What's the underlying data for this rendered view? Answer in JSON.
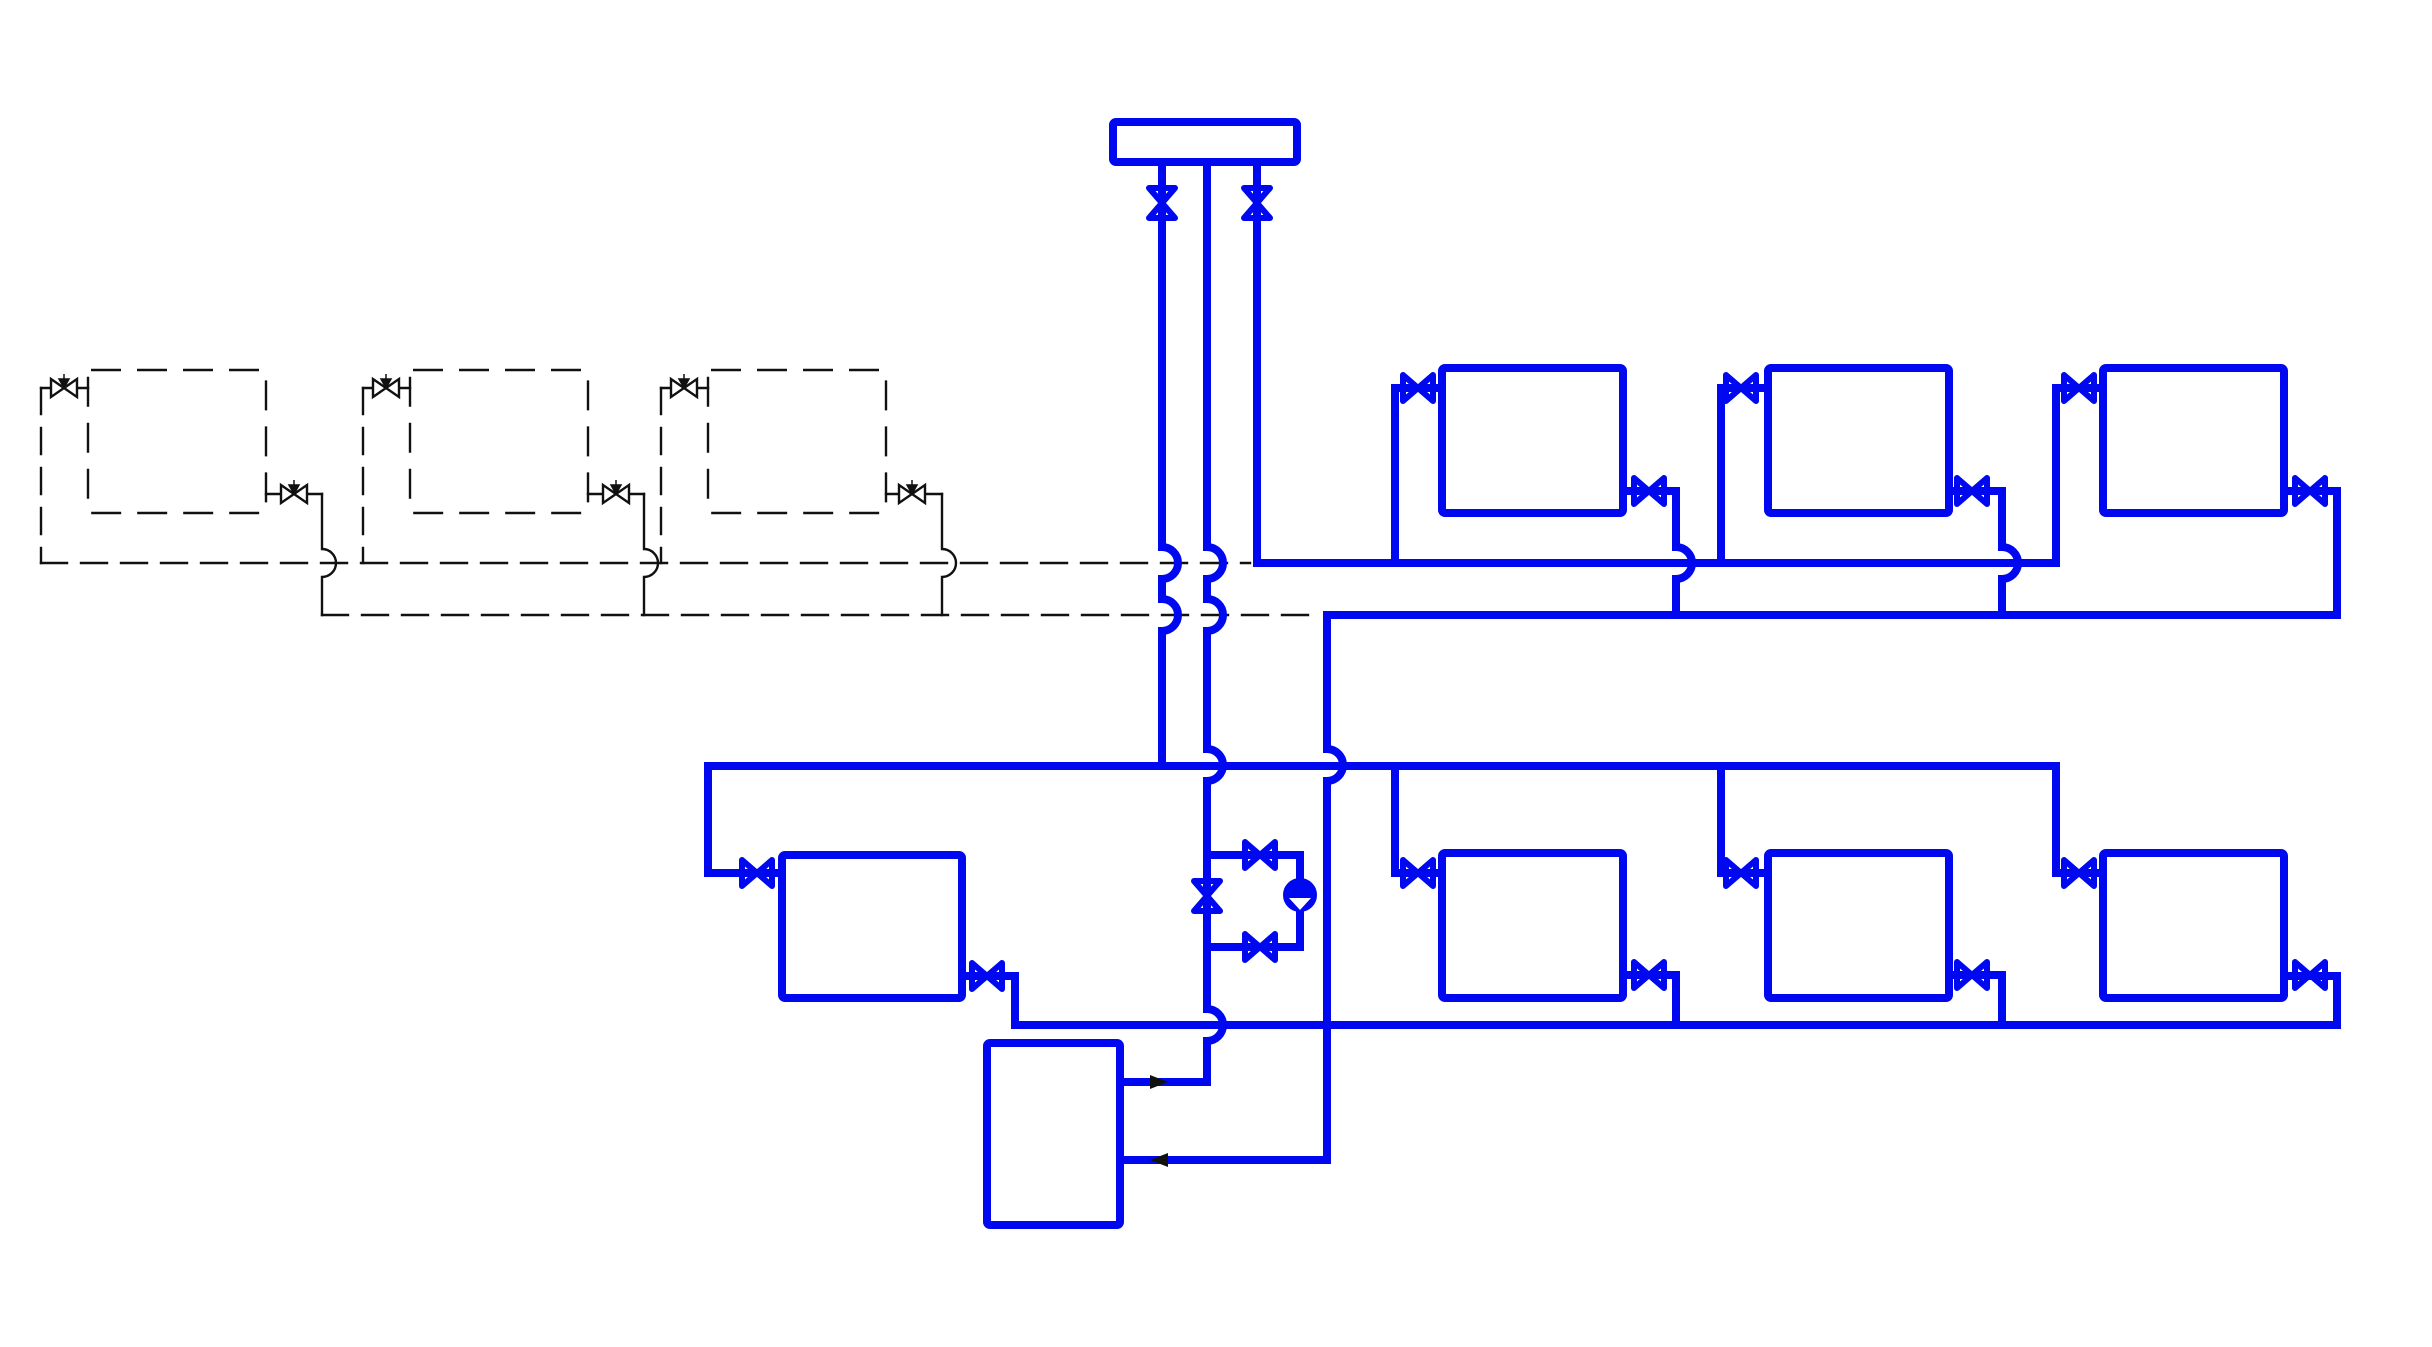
{
  "diagram": {
    "title": "heating-system-piping-schematic",
    "canvas": {
      "width": 2432,
      "height": 1347
    },
    "colors": {
      "pipe": "#0008f0",
      "planned": "#111111",
      "background": "#ffffff"
    },
    "stroke": {
      "pipe_width": 8,
      "planned_width": 2.4,
      "dash_line": "26 14",
      "dash_rect": "30 16"
    },
    "rects": [
      {
        "name": "supply-manifold",
        "x": 1113,
        "y": 122,
        "w": 184,
        "h": 40,
        "style": "pipe"
      },
      {
        "name": "boiler",
        "x": 987,
        "y": 1043,
        "w": 133,
        "h": 182,
        "style": "pipe"
      },
      {
        "name": "radiator-top-1",
        "x": 1442,
        "y": 368,
        "w": 181,
        "h": 145,
        "style": "pipe"
      },
      {
        "name": "radiator-top-2",
        "x": 1768,
        "y": 368,
        "w": 181,
        "h": 145,
        "style": "pipe"
      },
      {
        "name": "radiator-top-3",
        "x": 2103,
        "y": 368,
        "w": 181,
        "h": 145,
        "style": "pipe"
      },
      {
        "name": "radiator-bottom-left",
        "x": 782,
        "y": 855,
        "w": 180,
        "h": 143,
        "style": "pipe"
      },
      {
        "name": "radiator-bottom-1",
        "x": 1442,
        "y": 853,
        "w": 181,
        "h": 145,
        "style": "pipe"
      },
      {
        "name": "radiator-bottom-2",
        "x": 1768,
        "y": 853,
        "w": 181,
        "h": 145,
        "style": "pipe"
      },
      {
        "name": "radiator-bottom-3",
        "x": 2103,
        "y": 853,
        "w": 181,
        "h": 145,
        "style": "pipe"
      },
      {
        "name": "radiator-planned-1",
        "x": 88,
        "y": 370,
        "w": 178,
        "h": 143,
        "style": "planned",
        "dashed": true
      },
      {
        "name": "radiator-planned-2",
        "x": 410,
        "y": 370,
        "w": 178,
        "h": 143,
        "style": "planned",
        "dashed": true
      },
      {
        "name": "radiator-planned-3",
        "x": 708,
        "y": 370,
        "w": 178,
        "h": 143,
        "style": "planned",
        "dashed": true
      }
    ],
    "paths": [
      {
        "name": "riser-1",
        "style": "pipe",
        "d": "M1162,162 V547 A16 16 0 0 1 1162,579 V599 A16 16 0 0 1 1162,631 V765"
      },
      {
        "name": "riser-2-pump-main",
        "style": "pipe",
        "d": "M1207,162 V547 A16 16 0 0 1 1207,579 V599 A16 16 0 0 1 1207,631 V749 A16 16 0 0 1 1207,781 V1009 A16 16 0 0 1 1207,1041 V1082 H1120"
      },
      {
        "name": "riser-3-top-supply",
        "style": "pipe",
        "d": "M1257,162 V563 H2056 V388 H2103"
      },
      {
        "name": "top-supply-branch-1",
        "style": "pipe",
        "d": "M1395,563 V388 H1442"
      },
      {
        "name": "top-supply-branch-2",
        "style": "pipe",
        "d": "M1721,563 V388 H1768"
      },
      {
        "name": "top-return-rad-1",
        "style": "pipe",
        "d": "M1623,491 H1676 V547 A16 16 0 0 1 1676,579 V615"
      },
      {
        "name": "top-return-rad-2",
        "style": "pipe",
        "d": "M1949,491 H2002 V547 A16 16 0 0 1 2002,579 V615"
      },
      {
        "name": "top-return-rad-3",
        "style": "pipe",
        "d": "M2284,491 H2337 V615"
      },
      {
        "name": "top-return-main-to-boiler",
        "style": "pipe",
        "d": "M2337,615 H1327 V749 A16 16 0 0 1 1327,781 V1160 H1120"
      },
      {
        "name": "bottom-supply-main",
        "style": "pipe",
        "d": "M708,873 V766 H2056 V873"
      },
      {
        "name": "bottom-supply-branch-1",
        "style": "pipe",
        "d": "M1395,766 V873 H1442"
      },
      {
        "name": "bottom-supply-branch-2",
        "style": "pipe",
        "d": "M1721,766 V873 H1768"
      },
      {
        "name": "bottom-supply-stub-3",
        "style": "pipe",
        "d": "M2056,873 H2103"
      },
      {
        "name": "bottom-left-rad-stub-in",
        "style": "pipe",
        "d": "M708,873 H782"
      },
      {
        "name": "bottom-left-rad-out",
        "style": "pipe",
        "d": "M962,976 H1015 V1025"
      },
      {
        "name": "bottom-return-main",
        "style": "pipe",
        "d": "M1015,1025 H2337 V976 H2284"
      },
      {
        "name": "bottom-return-rad-1",
        "style": "pipe",
        "d": "M1623,975 H1676 V1025"
      },
      {
        "name": "bottom-return-rad-2",
        "style": "pipe",
        "d": "M1949,975 H2002 V1025"
      },
      {
        "name": "pump-bypass-loop",
        "style": "pipe",
        "d": "M1207,855 H1300 V947 H1207"
      },
      {
        "name": "planned-stub-in-1",
        "style": "planned",
        "d": "M41,388 H88"
      },
      {
        "name": "planned-stub-in-2",
        "style": "planned",
        "d": "M363,388 H410"
      },
      {
        "name": "planned-stub-in-3",
        "style": "planned",
        "d": "M661,388 H708"
      },
      {
        "name": "planned-stub-out-1",
        "style": "planned",
        "d": "M266,494 H322"
      },
      {
        "name": "planned-stub-out-2",
        "style": "planned",
        "d": "M588,494 H644"
      },
      {
        "name": "planned-stub-out-3",
        "style": "planned",
        "d": "M886,494 H942"
      },
      {
        "name": "planned-return-drop-1",
        "style": "planned",
        "d": "M322,494 V549 A14 14 0 0 1 322,577 V615"
      },
      {
        "name": "planned-return-drop-2",
        "style": "planned",
        "d": "M644,494 V549 A14 14 0 0 1 644,577 V615"
      },
      {
        "name": "planned-return-drop-3",
        "style": "planned",
        "d": "M942,494 V549 A14 14 0 0 1 942,577 V615"
      },
      {
        "name": "planned-supply-riser-1",
        "style": "planned",
        "dashed": true,
        "d": "M41,388 V563"
      },
      {
        "name": "planned-supply-riser-2",
        "style": "planned",
        "dashed": true,
        "d": "M363,388 V563"
      },
      {
        "name": "planned-supply-riser-3",
        "style": "planned",
        "dashed": true,
        "d": "M661,388 V563"
      },
      {
        "name": "planned-supply-main",
        "style": "planned",
        "dashed": true,
        "d": "M41,563 H1250"
      },
      {
        "name": "planned-return-main",
        "style": "planned",
        "dashed": true,
        "d": "M322,615 H1315"
      }
    ],
    "valves": [
      {
        "name": "valve-riser-1",
        "x": 1162,
        "y": 203,
        "orient": "v",
        "style": "pipe"
      },
      {
        "name": "valve-riser-3",
        "x": 1257,
        "y": 203,
        "orient": "v",
        "style": "pipe"
      },
      {
        "name": "valve-pump-main",
        "x": 1207,
        "y": 896,
        "orient": "v",
        "style": "pipe"
      },
      {
        "name": "valve-pump-bypass-top",
        "x": 1260,
        "y": 855,
        "orient": "h",
        "style": "pipe"
      },
      {
        "name": "valve-pump-bypass-bottom",
        "x": 1260,
        "y": 947,
        "orient": "h",
        "style": "pipe"
      },
      {
        "name": "valve-top-rad1-in",
        "x": 1418,
        "y": 388,
        "orient": "h",
        "style": "pipe"
      },
      {
        "name": "valve-top-rad2-in",
        "x": 1741,
        "y": 388,
        "orient": "h",
        "style": "pipe"
      },
      {
        "name": "valve-top-rad3-in",
        "x": 2079,
        "y": 388,
        "orient": "h",
        "style": "pipe"
      },
      {
        "name": "valve-top-rad1-out",
        "x": 1649,
        "y": 491,
        "orient": "h",
        "style": "pipe"
      },
      {
        "name": "valve-top-rad2-out",
        "x": 1972,
        "y": 491,
        "orient": "h",
        "style": "pipe"
      },
      {
        "name": "valve-top-rad3-out",
        "x": 2310,
        "y": 491,
        "orient": "h",
        "style": "pipe"
      },
      {
        "name": "valve-bottomleft-in",
        "x": 757,
        "y": 873,
        "orient": "h",
        "style": "pipe"
      },
      {
        "name": "valve-bottomleft-out",
        "x": 987,
        "y": 976,
        "orient": "h",
        "style": "pipe"
      },
      {
        "name": "valve-bottom-rad1-in",
        "x": 1418,
        "y": 873,
        "orient": "h",
        "style": "pipe"
      },
      {
        "name": "valve-bottom-rad2-in",
        "x": 1741,
        "y": 873,
        "orient": "h",
        "style": "pipe"
      },
      {
        "name": "valve-bottom-rad3-in",
        "x": 2079,
        "y": 873,
        "orient": "h",
        "style": "pipe"
      },
      {
        "name": "valve-bottom-rad1-out",
        "x": 1649,
        "y": 975,
        "orient": "h",
        "style": "pipe"
      },
      {
        "name": "valve-bottom-rad2-out",
        "x": 1972,
        "y": 975,
        "orient": "h",
        "style": "pipe"
      },
      {
        "name": "valve-bottom-rad3-out",
        "x": 2310,
        "y": 975,
        "orient": "h",
        "style": "pipe"
      },
      {
        "name": "valve-planned-rad1-in",
        "x": 64,
        "y": 388,
        "orient": "h",
        "style": "planned"
      },
      {
        "name": "valve-planned-rad2-in",
        "x": 386,
        "y": 388,
        "orient": "h",
        "style": "planned"
      },
      {
        "name": "valve-planned-rad3-in",
        "x": 684,
        "y": 388,
        "orient": "h",
        "style": "planned"
      },
      {
        "name": "valve-planned-rad1-out",
        "x": 294,
        "y": 494,
        "orient": "h",
        "style": "planned"
      },
      {
        "name": "valve-planned-rad2-out",
        "x": 616,
        "y": 494,
        "orient": "h",
        "style": "planned"
      },
      {
        "name": "valve-planned-rad3-out",
        "x": 912,
        "y": 494,
        "orient": "h",
        "style": "planned"
      }
    ],
    "pump": {
      "name": "circulation-pump",
      "cx": 1300,
      "cy": 895,
      "r": 15
    },
    "arrows": [
      {
        "name": "flow-arrow-boiler-outlet",
        "dir": "right",
        "points": "1150,1075 1168,1082 1150,1089"
      },
      {
        "name": "flow-arrow-boiler-return",
        "dir": "left",
        "points": "1168,1153 1150,1160 1168,1167"
      }
    ]
  }
}
